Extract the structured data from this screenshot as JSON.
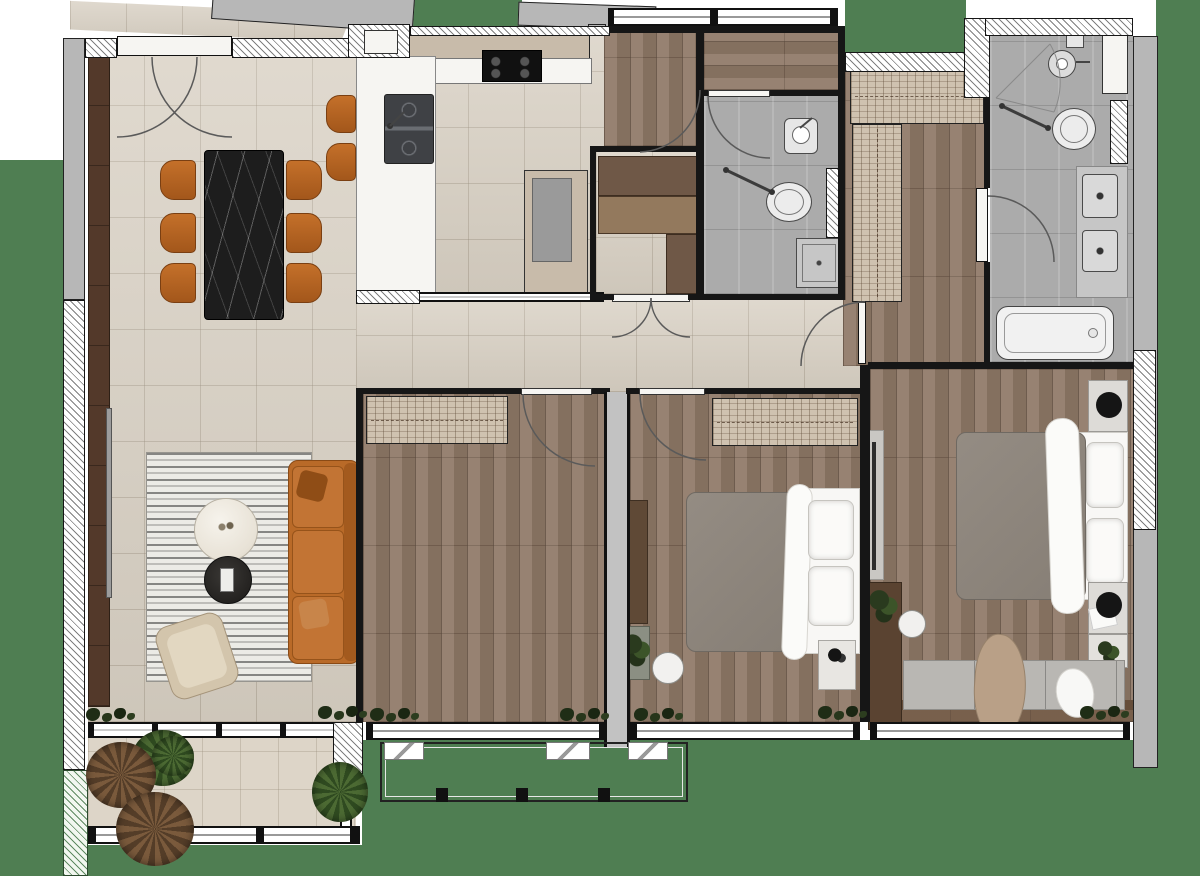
{
  "title": "apartment-floor-plan",
  "palette": {
    "green_outdoor": "#4f7e52",
    "beige_floor": "#d9d1c4",
    "balcony_floor": "#ddd5c8",
    "wood_floor": "#8f7967",
    "wood_dark": "#6e543f",
    "gray_tile": "#ababab",
    "wall_black": "#161616",
    "wall_gray": "#b7b7b7",
    "divider_gray": "#c2c2c2",
    "marble_black": "#1d1d1d",
    "cabinet_tan": "#c8bbaa",
    "wardrobe_tan": "#cfc2b0",
    "sofa_orange": "#b96a28",
    "chair_orange": "#b4661f",
    "duvet_gray": "#8d857c",
    "linen_white": "#f8f7f5",
    "rug_base": "#ecebe6",
    "plant_green": "#4c6a33",
    "plant_dry": "#7a5a3c",
    "counter_white": "#f5f4f2"
  },
  "rooms": [
    {
      "id": "entry-corridor",
      "label": "angled entry corridor outside unit"
    },
    {
      "id": "dining-area",
      "label": "dining area, black marble table, 6 orange chairs"
    },
    {
      "id": "kitchen",
      "label": "kitchen with island, sink, cooktop, tall fridge unit, 2 bar stools"
    },
    {
      "id": "pantry",
      "label": "pantry closet with double swing doors and shelving"
    },
    {
      "id": "hallway",
      "label": "wood-floor hall and corridor"
    },
    {
      "id": "bathroom-1",
      "label": "guest bathroom: basin, toilet, shower tray"
    },
    {
      "id": "walk-in-closet",
      "label": "walk-in closet with L-shaped wardrobes"
    },
    {
      "id": "master-bathroom",
      "label": "master bathroom: basin, toilet, twin trays, bathtub"
    },
    {
      "id": "master-bedroom",
      "label": "master bedroom: double bed, nightstands, bench, dresser"
    },
    {
      "id": "bedroom-2",
      "label": "bedroom with double bed, wardrobe, desk"
    },
    {
      "id": "bedroom-3",
      "label": "empty bedroom with wardrobe"
    },
    {
      "id": "living-room",
      "label": "living room: striped rug, orange sofa, marble coffee table, armchair"
    },
    {
      "id": "balcony",
      "label": "balcony with plants and railing"
    },
    {
      "id": "terrace-strip",
      "label": "narrow railing strip below bedrooms"
    }
  ],
  "furniture_counts": {
    "dining_chairs": 6,
    "bar_stools": 2,
    "beds": 2,
    "bathrooms": 2,
    "wardrobes": 4,
    "sofas": 1,
    "armchairs": 1
  }
}
